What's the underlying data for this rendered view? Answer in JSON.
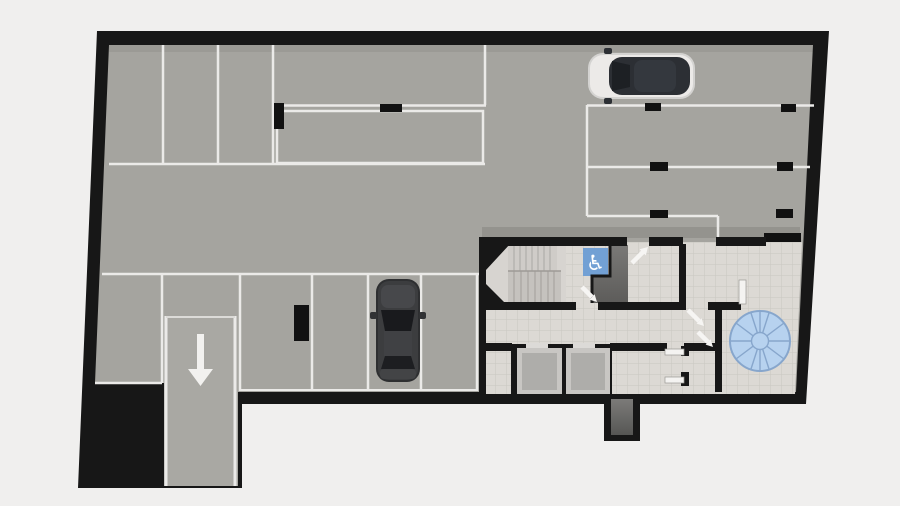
{
  "scene": {
    "kind": "architectural-floor-plan",
    "level_type": "underground-parking-garage"
  },
  "symbols": {
    "accessible_parking_glyph": "♿",
    "ramp_arrow_direction": "down",
    "ventilation_fan_spokes": 10
  },
  "colors": {
    "background": "#f0efee",
    "wall": "#171717",
    "parking_floor": "#a5a49f",
    "core_tile_floor": "#dcd9d4",
    "marking_lines": "#ebeae8",
    "accessible_sign_bg": "#72a0d4",
    "fan_fill": "#b7d2ef",
    "fan_stroke": "#87a6cc",
    "dark_vestibule": "#6e6d6b",
    "elevator_floor": "#aeadaa",
    "elevator_frame": "#c8c6c3",
    "stair_tread": "#cfccc8",
    "car_silver_body": "#eceae8",
    "car_dark_body": "#3c3d3f"
  },
  "features": {
    "cars": [
      {
        "name": "silver-car",
        "facing": "left",
        "location": "top-right-stall"
      },
      {
        "name": "dark-grey-car",
        "facing": "up",
        "location": "bottom-center-stall"
      }
    ],
    "rooms": [
      "stairwell",
      "vestibule",
      "elevator-shaft-1",
      "elevator-shaft-2",
      "corridor",
      "storage-room",
      "fan-room"
    ],
    "parking_markings": {
      "top_row_stalls": 4,
      "right_column_stalls": 3,
      "bottom_row_stalls": 5,
      "accessible_stalls": 1
    }
  }
}
